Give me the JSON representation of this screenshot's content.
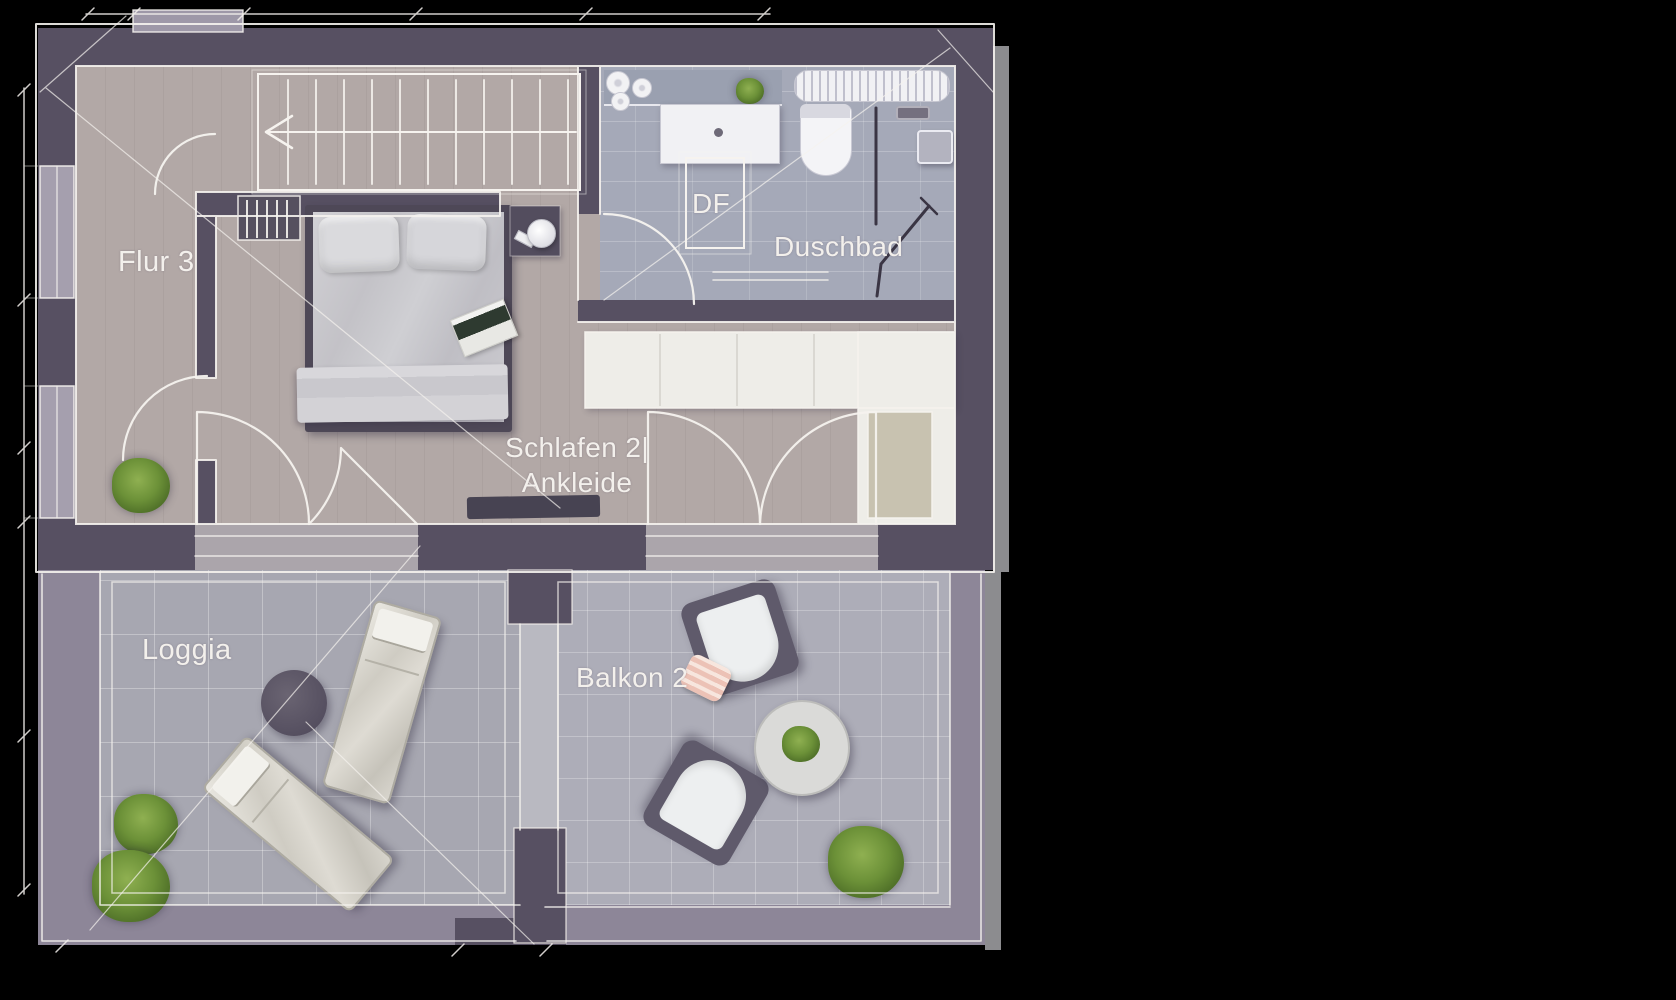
{
  "app": {
    "type": "architectural-floor-plan",
    "view": "top-down upper floor",
    "style": "hand-drawn sketch render"
  },
  "labels": {
    "flur": "Flur 3",
    "df": "DF",
    "duschbad": "Duschbad",
    "schlafen_line1": "Schlafen 2|",
    "schlafen_line2": "Ankleide",
    "loggia": "Loggia",
    "balkon": "Balkon 2"
  },
  "rooms": [
    {
      "id": "flur-3",
      "label": "Flur 3"
    },
    {
      "id": "duschbad",
      "label": "Duschbad",
      "annotation": "DF"
    },
    {
      "id": "schlafen-2-ankleide",
      "label": "Schlafen 2| Ankleide"
    },
    {
      "id": "loggia",
      "label": "Loggia"
    },
    {
      "id": "balkon-2",
      "label": "Balkon 2"
    }
  ],
  "furniture": {
    "flur": [
      "staircase-with-direction-arrow",
      "radiator",
      "potted-plant"
    ],
    "duschbad": [
      "vanity-sink",
      "roof-window-DF",
      "toilet",
      "shower-glass",
      "shower-head",
      "shower-control",
      "towel-radiator",
      "towel-rolls",
      "small-plant"
    ],
    "schlafen": [
      "double-bed",
      "pillows",
      "blanket",
      "magazine",
      "nightstand",
      "lamp",
      "wardrobe-l-shape",
      "doormat-bench"
    ],
    "loggia": [
      "sun-lounger",
      "sun-lounger",
      "round-side-table",
      "potted-plants"
    ],
    "balkon": [
      "armchair",
      "armchair",
      "round-coffee-table",
      "pink-pillow",
      "potted-plant"
    ]
  },
  "colors": {
    "background": "#000000",
    "wall_dark": "#575062",
    "parapet_light": "#8d8698",
    "sketch_line": "#f6f3ef",
    "floor_room": "#b2a8a6",
    "floor_bath": "#a5a9b8",
    "floor_loggia": "#a7a7b1",
    "floor_balkon": "#adadb8",
    "closet_white": "#eeede8",
    "closet_inset_tan": "#c8c2b0",
    "bed_frame": "#4e4857",
    "furniture_dark": "#5f5a6b",
    "plant_green": "#6c9138",
    "pillow_pink": "#ecc2b6",
    "label_text": "#f3f0ec",
    "shadow_gray": "#8c8c8f"
  }
}
